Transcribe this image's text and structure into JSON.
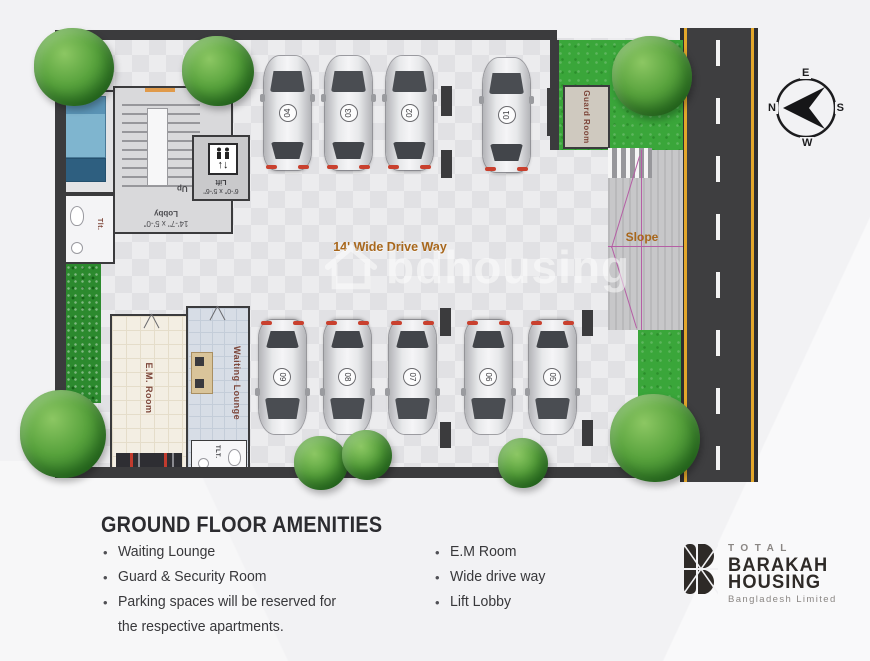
{
  "plan": {
    "drive_way_label": "14' Wide Drive Way",
    "slope_label": "Slope",
    "up_label": "Up",
    "lobby_label": "Lobby",
    "lobby_size": "14'-7\" x 5'-0\"",
    "lift_label": "Lift",
    "lift_size": "6'-0\" x 5'-6\"",
    "lift_arrows": "↑↓",
    "guard_bed_label": "Guard BED",
    "guard_room_label": "Guard Room",
    "toilet_small_label": "Tlt.",
    "toilet_big_label": "TLT.",
    "em_room_label": "E.M. Room",
    "waiting_lounge_label": "Waiting Lounge",
    "cars": [
      "04",
      "03",
      "02",
      "01",
      "09",
      "08",
      "07",
      "06",
      "05"
    ],
    "compass": {
      "n": "N",
      "e": "E",
      "s": "S",
      "w": "W"
    }
  },
  "watermark": {
    "text": "bdhousing"
  },
  "amenities": {
    "title": "GROUND FLOOR AMENITIES",
    "bullet": "•",
    "col1": [
      "Waiting  Lounge",
      "Guard & Security Room",
      "Parking spaces will be reserved for the respective apartments."
    ],
    "col2": [
      "E.M Room",
      "Wide drive way",
      "Lift Lobby"
    ]
  },
  "logo": {
    "total": "TOTAL",
    "line1": "BARAKAH",
    "line2": "HOUSING",
    "subtitle": "Bangladesh Limited"
  },
  "colors": {
    "grass": "#3aa63a",
    "wall": "#3b3b3d",
    "road_yellow": "#e3a72b",
    "slope_line": "#b55fa5",
    "label_brown": "#7d463a",
    "label_orange": "#a8671c"
  }
}
